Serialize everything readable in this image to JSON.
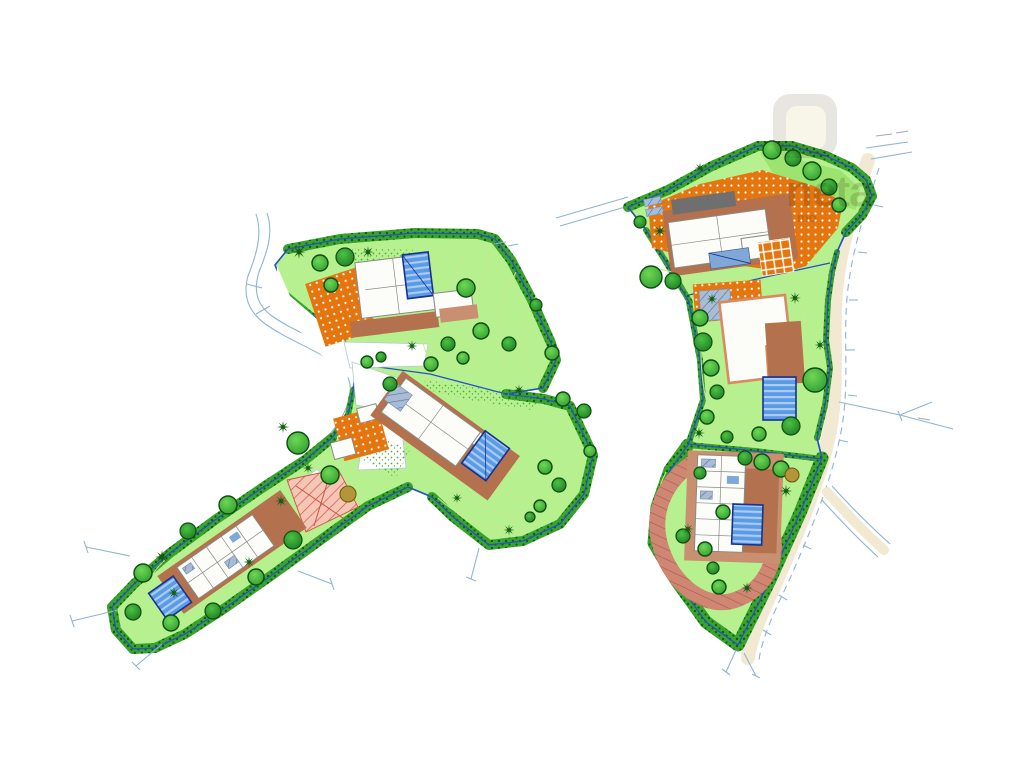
{
  "watermark": {
    "text": "neta",
    "subtext": "mo",
    "logo": "rounded-square-logo"
  },
  "palette": {
    "page_bg": "#ffffff",
    "lawn": "#b7f18f",
    "lawn_dark": "#9ce46f",
    "veg": "#3aa32e",
    "veg_dark": "#135c13",
    "tree_light": "#6fd757",
    "tree_base": "#2f9e2f",
    "tree2_light": "#4cc244",
    "tree2_base": "#1d7d22",
    "tree_edge": "#0e4d10",
    "olive_tree": "#b5953a",
    "boundary": "#2451c8",
    "road_line": "#8fb4d4",
    "road_fill": "#f2e9d2",
    "terrace_orange": "#e5760f",
    "terrace_brown": "#b3714d",
    "deck_brown": "#c89070",
    "brick": "#cf8672",
    "pool": "#5b9be6",
    "pool_stripe": "#a9cbf4",
    "pool_edge": "#16338f",
    "hatch_pink_bg": "#f5c6b6",
    "hatch_pink_line": "#cc5544",
    "hatch_blue_bg": "#a8bcd4",
    "building_white": "#fcfcf8",
    "building_edge": "#8a8a86",
    "roof_dark": "#6f6f6f",
    "salmon_edge": "#d98a60",
    "contour": "#c9e890",
    "watermark_gray": "#b3ac97"
  }
}
